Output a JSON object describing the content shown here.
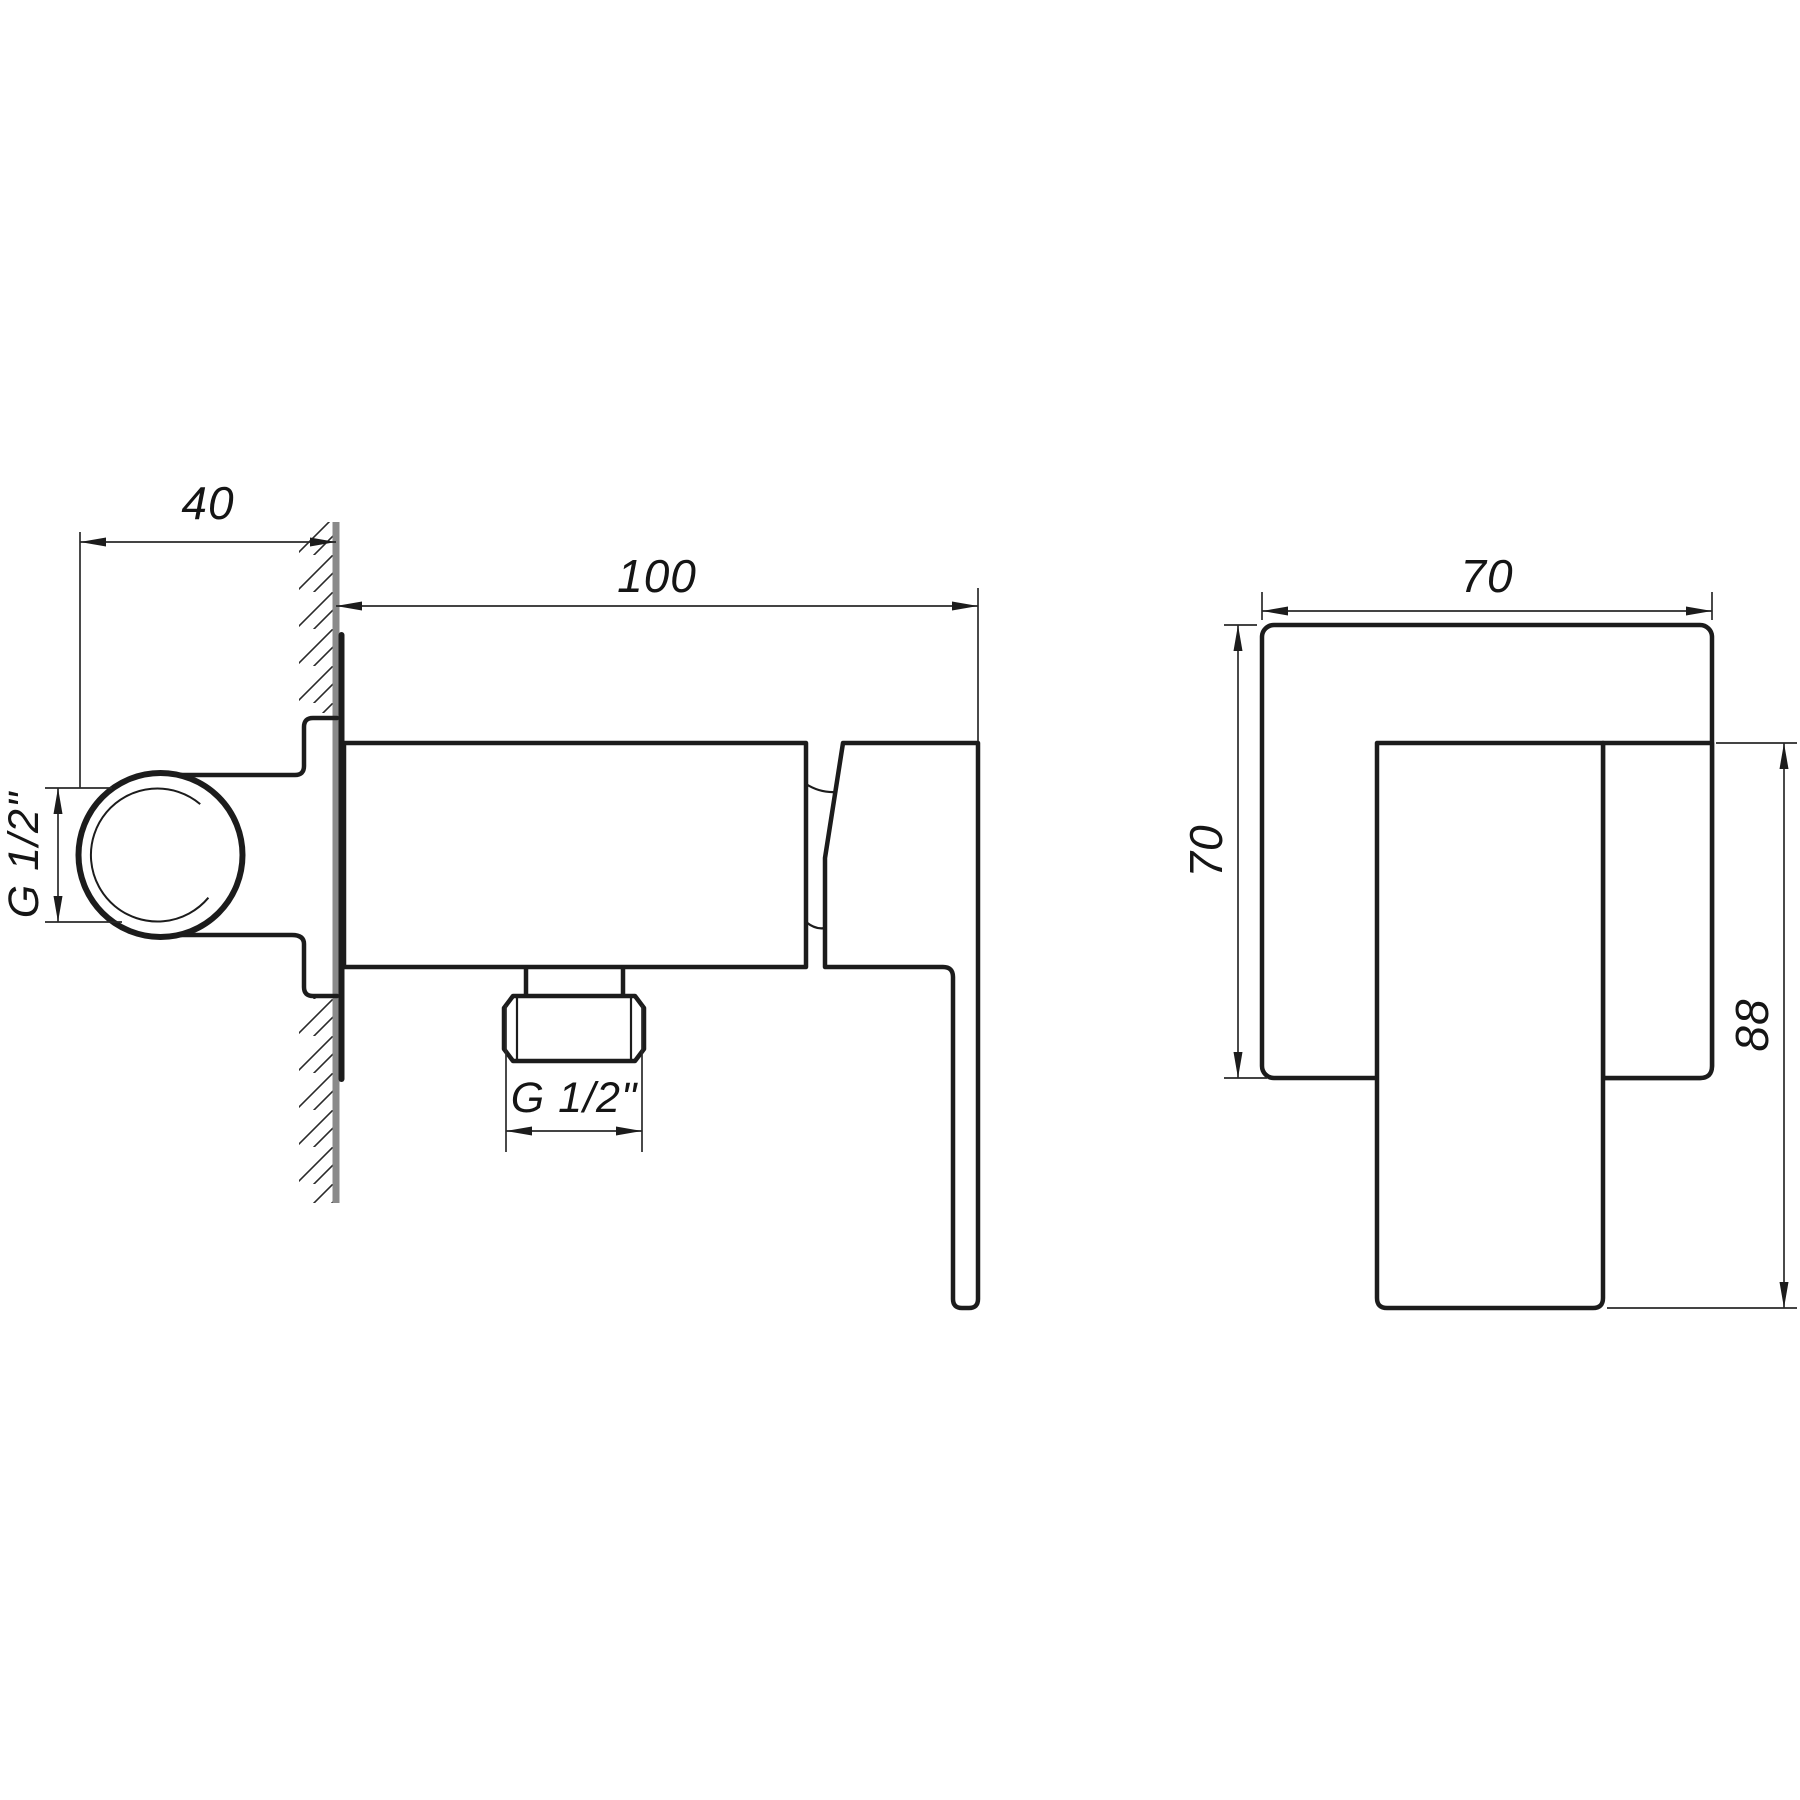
{
  "drawing": {
    "title": "wall-mounted single-lever mixer, two orthographic projection views",
    "background_color": "#ffffff",
    "line_color": "#1c1c1c",
    "wall_section_color": "#8a8a8a",
    "side_view": {
      "name": "side view with wall section",
      "dims": {
        "depth": {
          "label": "40",
          "value_mm": 40,
          "meaning": "depth of concealed elbow behind wall"
        },
        "length": {
          "label": "100",
          "value_mm": 100,
          "meaning": "projection of body from wall"
        },
        "inlet_thread": {
          "label": "G 1/2\"",
          "meaning": "inlet connection thread"
        },
        "outlet_thread": {
          "label": "G 1/2\"",
          "meaning": "bottom outlet thread"
        }
      }
    },
    "front_view": {
      "name": "front view",
      "dims": {
        "width": {
          "label": "70",
          "value_mm": 70,
          "meaning": "face plate width"
        },
        "height": {
          "label": "70",
          "value_mm": 70,
          "meaning": "face plate height"
        },
        "handle_height": {
          "label": "88",
          "value_mm": 88,
          "meaning": "handle overall height"
        }
      }
    }
  }
}
